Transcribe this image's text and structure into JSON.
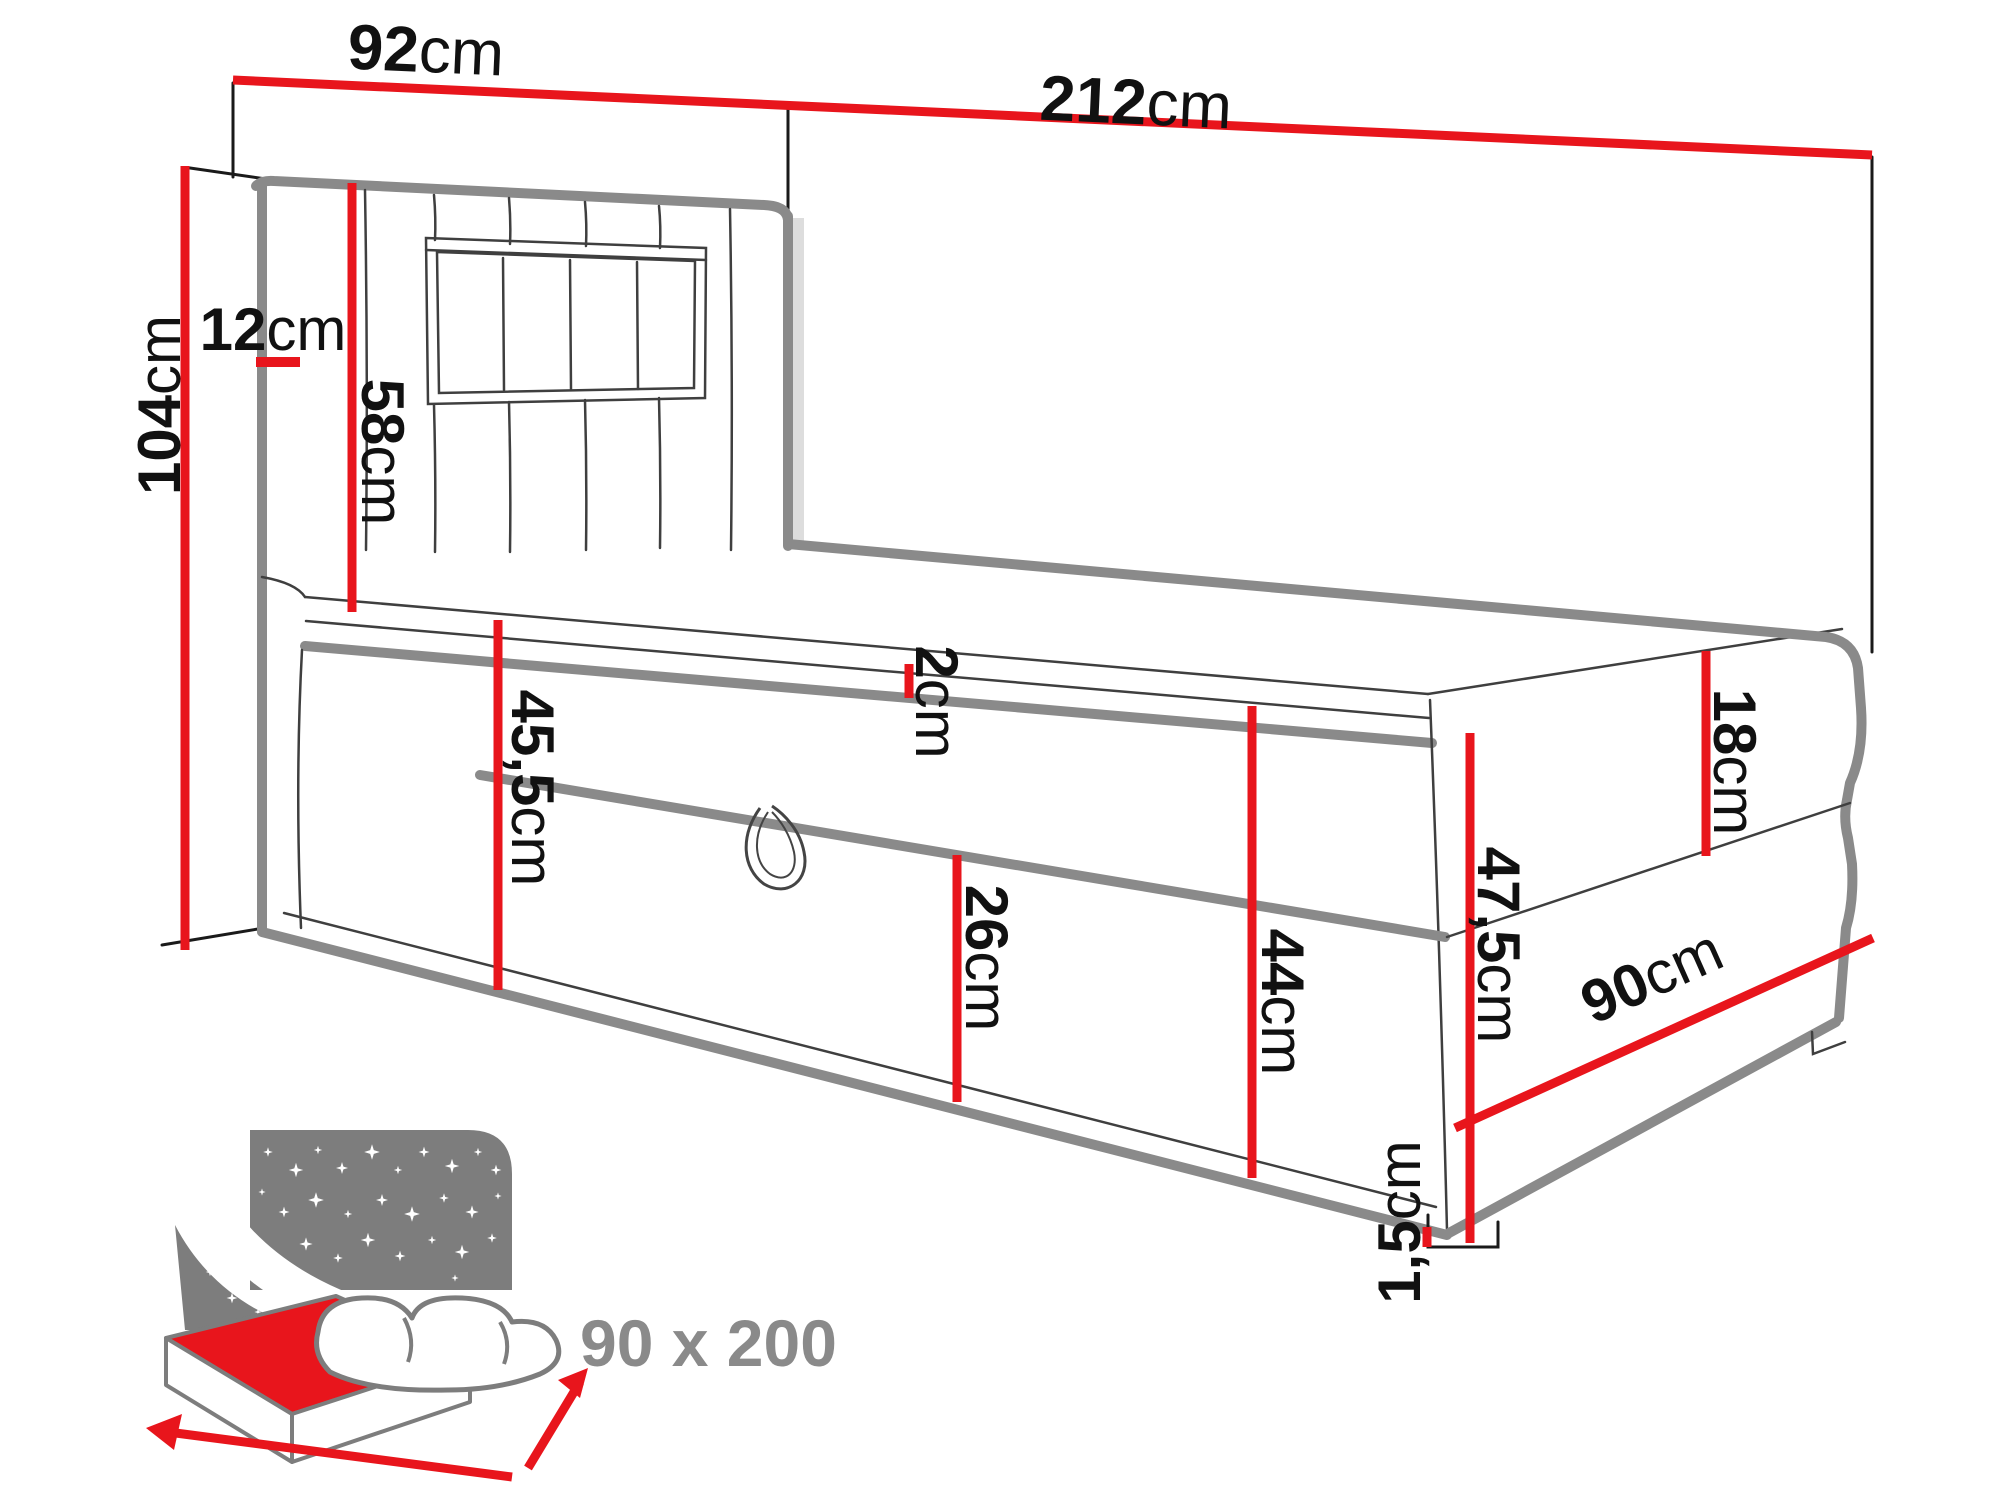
{
  "diagram": {
    "title": "bed-dimension-diagram",
    "dims": {
      "w92": {
        "v": "92",
        "u": "cm"
      },
      "w212": {
        "v": "212",
        "u": "cm"
      },
      "h104": {
        "v": "104",
        "u": "cm"
      },
      "d12": {
        "v": "12",
        "u": "cm"
      },
      "h58": {
        "v": "58",
        "u": "cm"
      },
      "t2": {
        "v": "2",
        "u": "cm"
      },
      "h45_5": {
        "v": "45,5",
        "u": "cm"
      },
      "h26": {
        "v": "26",
        "u": "cm"
      },
      "h44": {
        "v": "44",
        "u": "cm"
      },
      "h18": {
        "v": "18",
        "u": "cm"
      },
      "h47_5": {
        "v": "47,5",
        "u": "cm"
      },
      "w90": {
        "v": "90",
        "u": "cm"
      },
      "h1_5": {
        "v": "1,5",
        "u": "cm"
      }
    },
    "icon": {
      "size_label": "90 x 200"
    },
    "colors": {
      "dimension_red": "#e8151c",
      "outline_gray": "#8a8a8a",
      "icon_gray": "#7d7d7d",
      "text_black": "#111111"
    }
  }
}
